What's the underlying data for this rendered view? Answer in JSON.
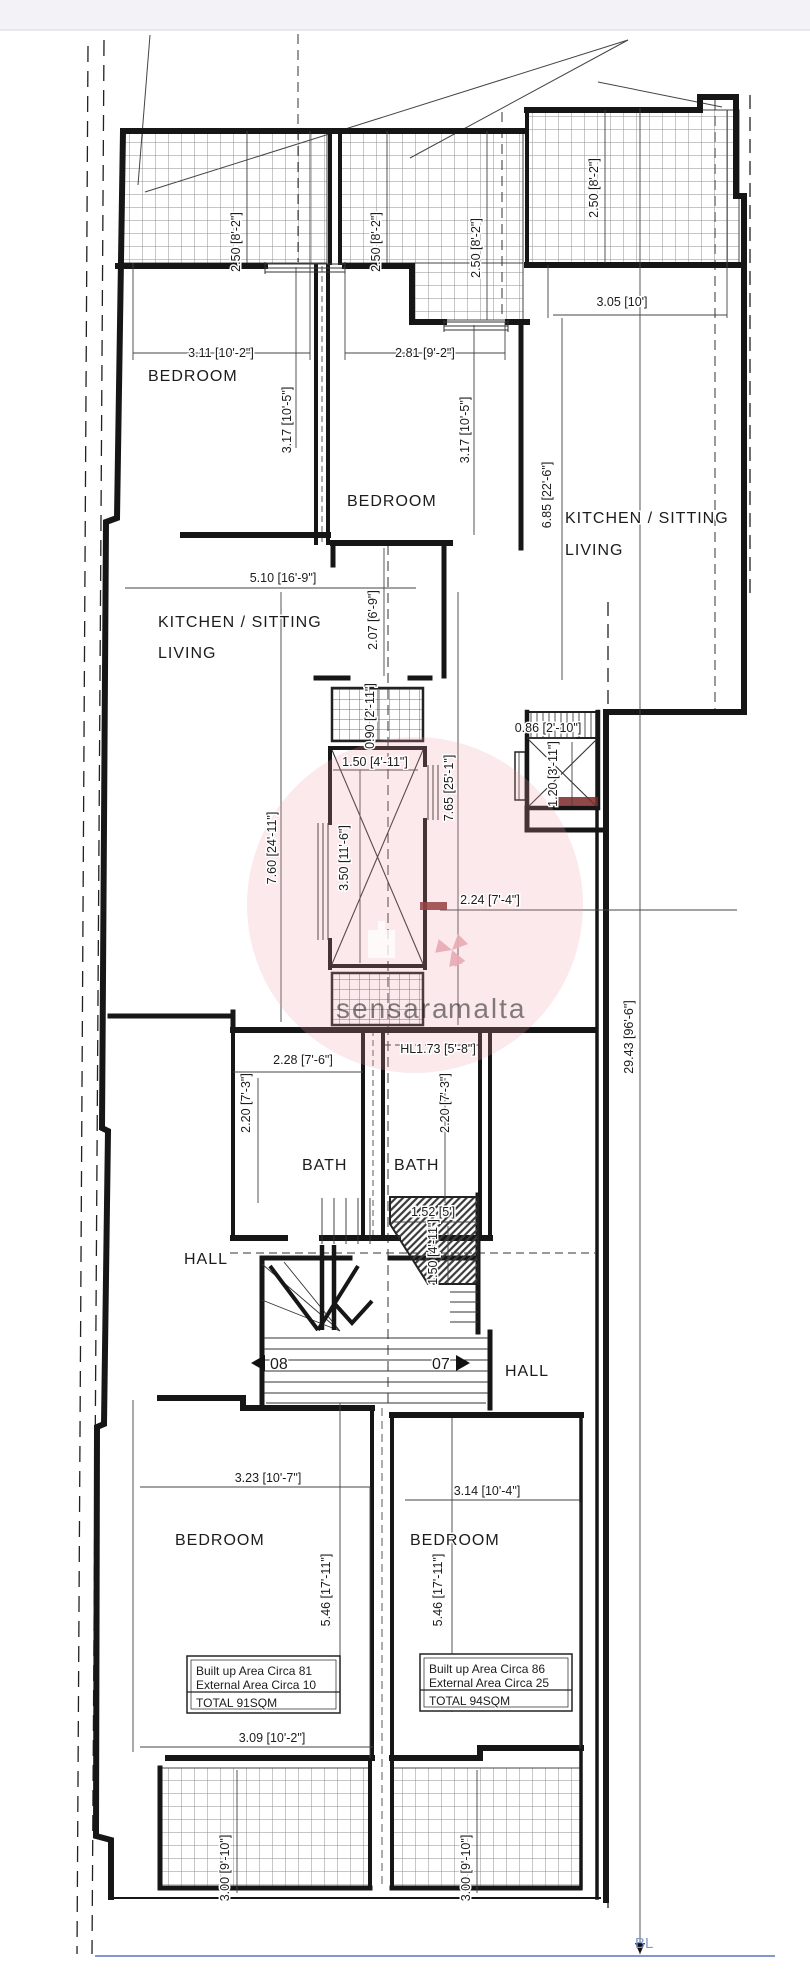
{
  "watermark": {
    "part1": "sensara",
    "part2": "malta"
  },
  "site": {
    "boundary_label": "BL"
  },
  "stairs": {
    "left_flight": "08",
    "right_flight": "07"
  },
  "rooms": {
    "bedroom_top_left": "BEDROOM",
    "bedroom_top_mid": "BEDROOM",
    "kitchen_left_line1": "KITCHEN / SITTING",
    "kitchen_left_line2": "LIVING",
    "kitchen_right_line1": "KITCHEN / SITTING",
    "kitchen_right_line2": "LIVING",
    "bath_left": "BATH",
    "bath_right": "BATH",
    "hall_left": "HALL",
    "hall_right": "HALL",
    "bedroom_bottom_left": "BEDROOM",
    "bedroom_bottom_right": "BEDROOM"
  },
  "dims": {
    "terrace_tl": "2.50 [8'-2\"]",
    "terrace_tm": "2.50 [8'-2\"]",
    "terrace_tm_r": "2.50 [8'-2\"]",
    "terrace_tr": "2.50 [8'-2\"]",
    "kitchen_r_width": "3.05 [10']",
    "bedroom_tl_width": "3.11 [10'-2\"]",
    "bedroom_tm_width": "2.81 [9'-2\"]",
    "bedroom_tl_depth": "3.17 [10'-5\"]",
    "bedroom_tm_depth": "3.17 [10'-5\"]",
    "kitchen_r_depth": "6.85 [22'-6\"]",
    "kitchen_l_width": "5.10 [16'-9\"]",
    "vestibule_depth": "2.07 [6'-9\"]",
    "apt_left_depth": "7.60 [24'-11\"]",
    "apt_right_depth": "7.65 [25'-1\"]",
    "duct_depth": "0.90 [2'-11\"]",
    "shaft_width": "1.50 [4'-11\"]",
    "shaft_depth": "3.50 [11'-6\"]",
    "lift_width": "0.86 [2'-10\"]",
    "lift_depth": "1.20 [3'-11\"]",
    "backyard_width": "2.24 [7'-4\"]",
    "overall_depth": "29.43 [96'-6\"]",
    "bath_width": "2.28 [7'-6\"]",
    "bath_left_depth": "2.20 [7'-3\"]",
    "bath_right_depth": "2.20 [7'-3\"]",
    "head_level": "HL1.73 [5'-8\"]",
    "stair_width": "1.52 [5']",
    "stair_depth": "1.50 [4'-11\"]",
    "bedroom_bl_width": "3.23 [10'-7\"]",
    "bedroom_br_width": "3.14 [10'-4\"]",
    "bedroom_bl_depth": "5.46 [17'-11\"]",
    "bedroom_br_depth": "5.46 [17'-11\"]",
    "terrace_b_width": "3.09 [10'-2\"]",
    "terrace_bl_depth": "3.00 [9'-10\"]",
    "terrace_br_depth": "3.00 [9'-10\"]"
  },
  "areas": {
    "left": {
      "line1": "Built up Area Circa 81",
      "line2": "External Area Circa 10",
      "total": "TOTAL 91SQM"
    },
    "right": {
      "line1": "Built up Area Circa 86",
      "line2": "External Area Circa 25",
      "total": "TOTAL 94SQM"
    }
  }
}
